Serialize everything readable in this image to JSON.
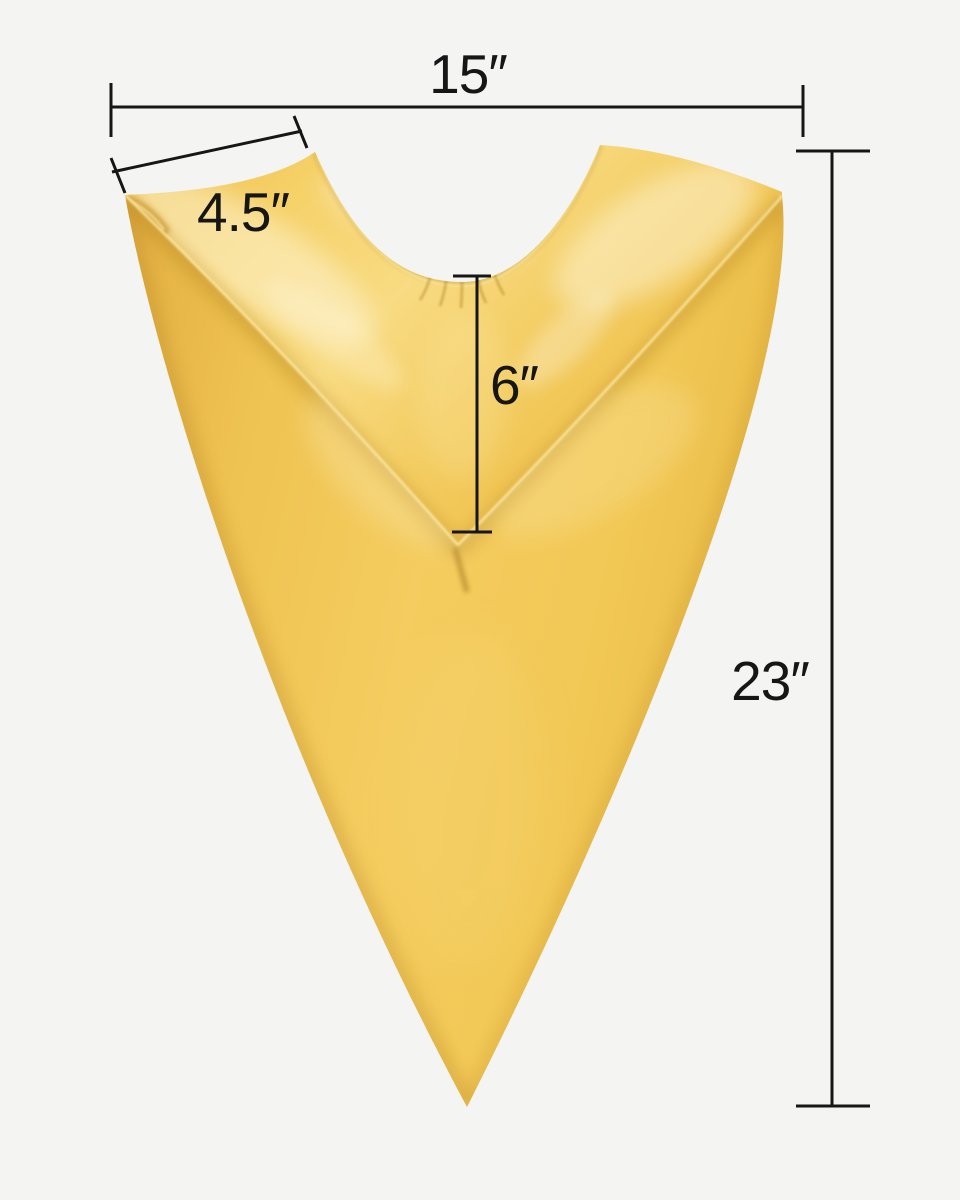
{
  "page": {
    "background_color": "#f4f4f3",
    "title": "Gold V-neck graduation stole dimension diagram"
  },
  "product": {
    "name": "gold satin v-neck stole",
    "colors": {
      "fabric_base": "#f2c654",
      "fabric_light": "#f8db82",
      "fabric_highlight": "#fdf0c2",
      "fabric_shadow": "#c8992f"
    }
  },
  "annotations": {
    "line_color": "#161616",
    "text_color": "#161616",
    "top_width": {
      "label": "15″"
    },
    "shoulder_width": {
      "label": "4.5″"
    },
    "neck_depth": {
      "label": "6″"
    },
    "side_length": {
      "label": "23″"
    }
  }
}
